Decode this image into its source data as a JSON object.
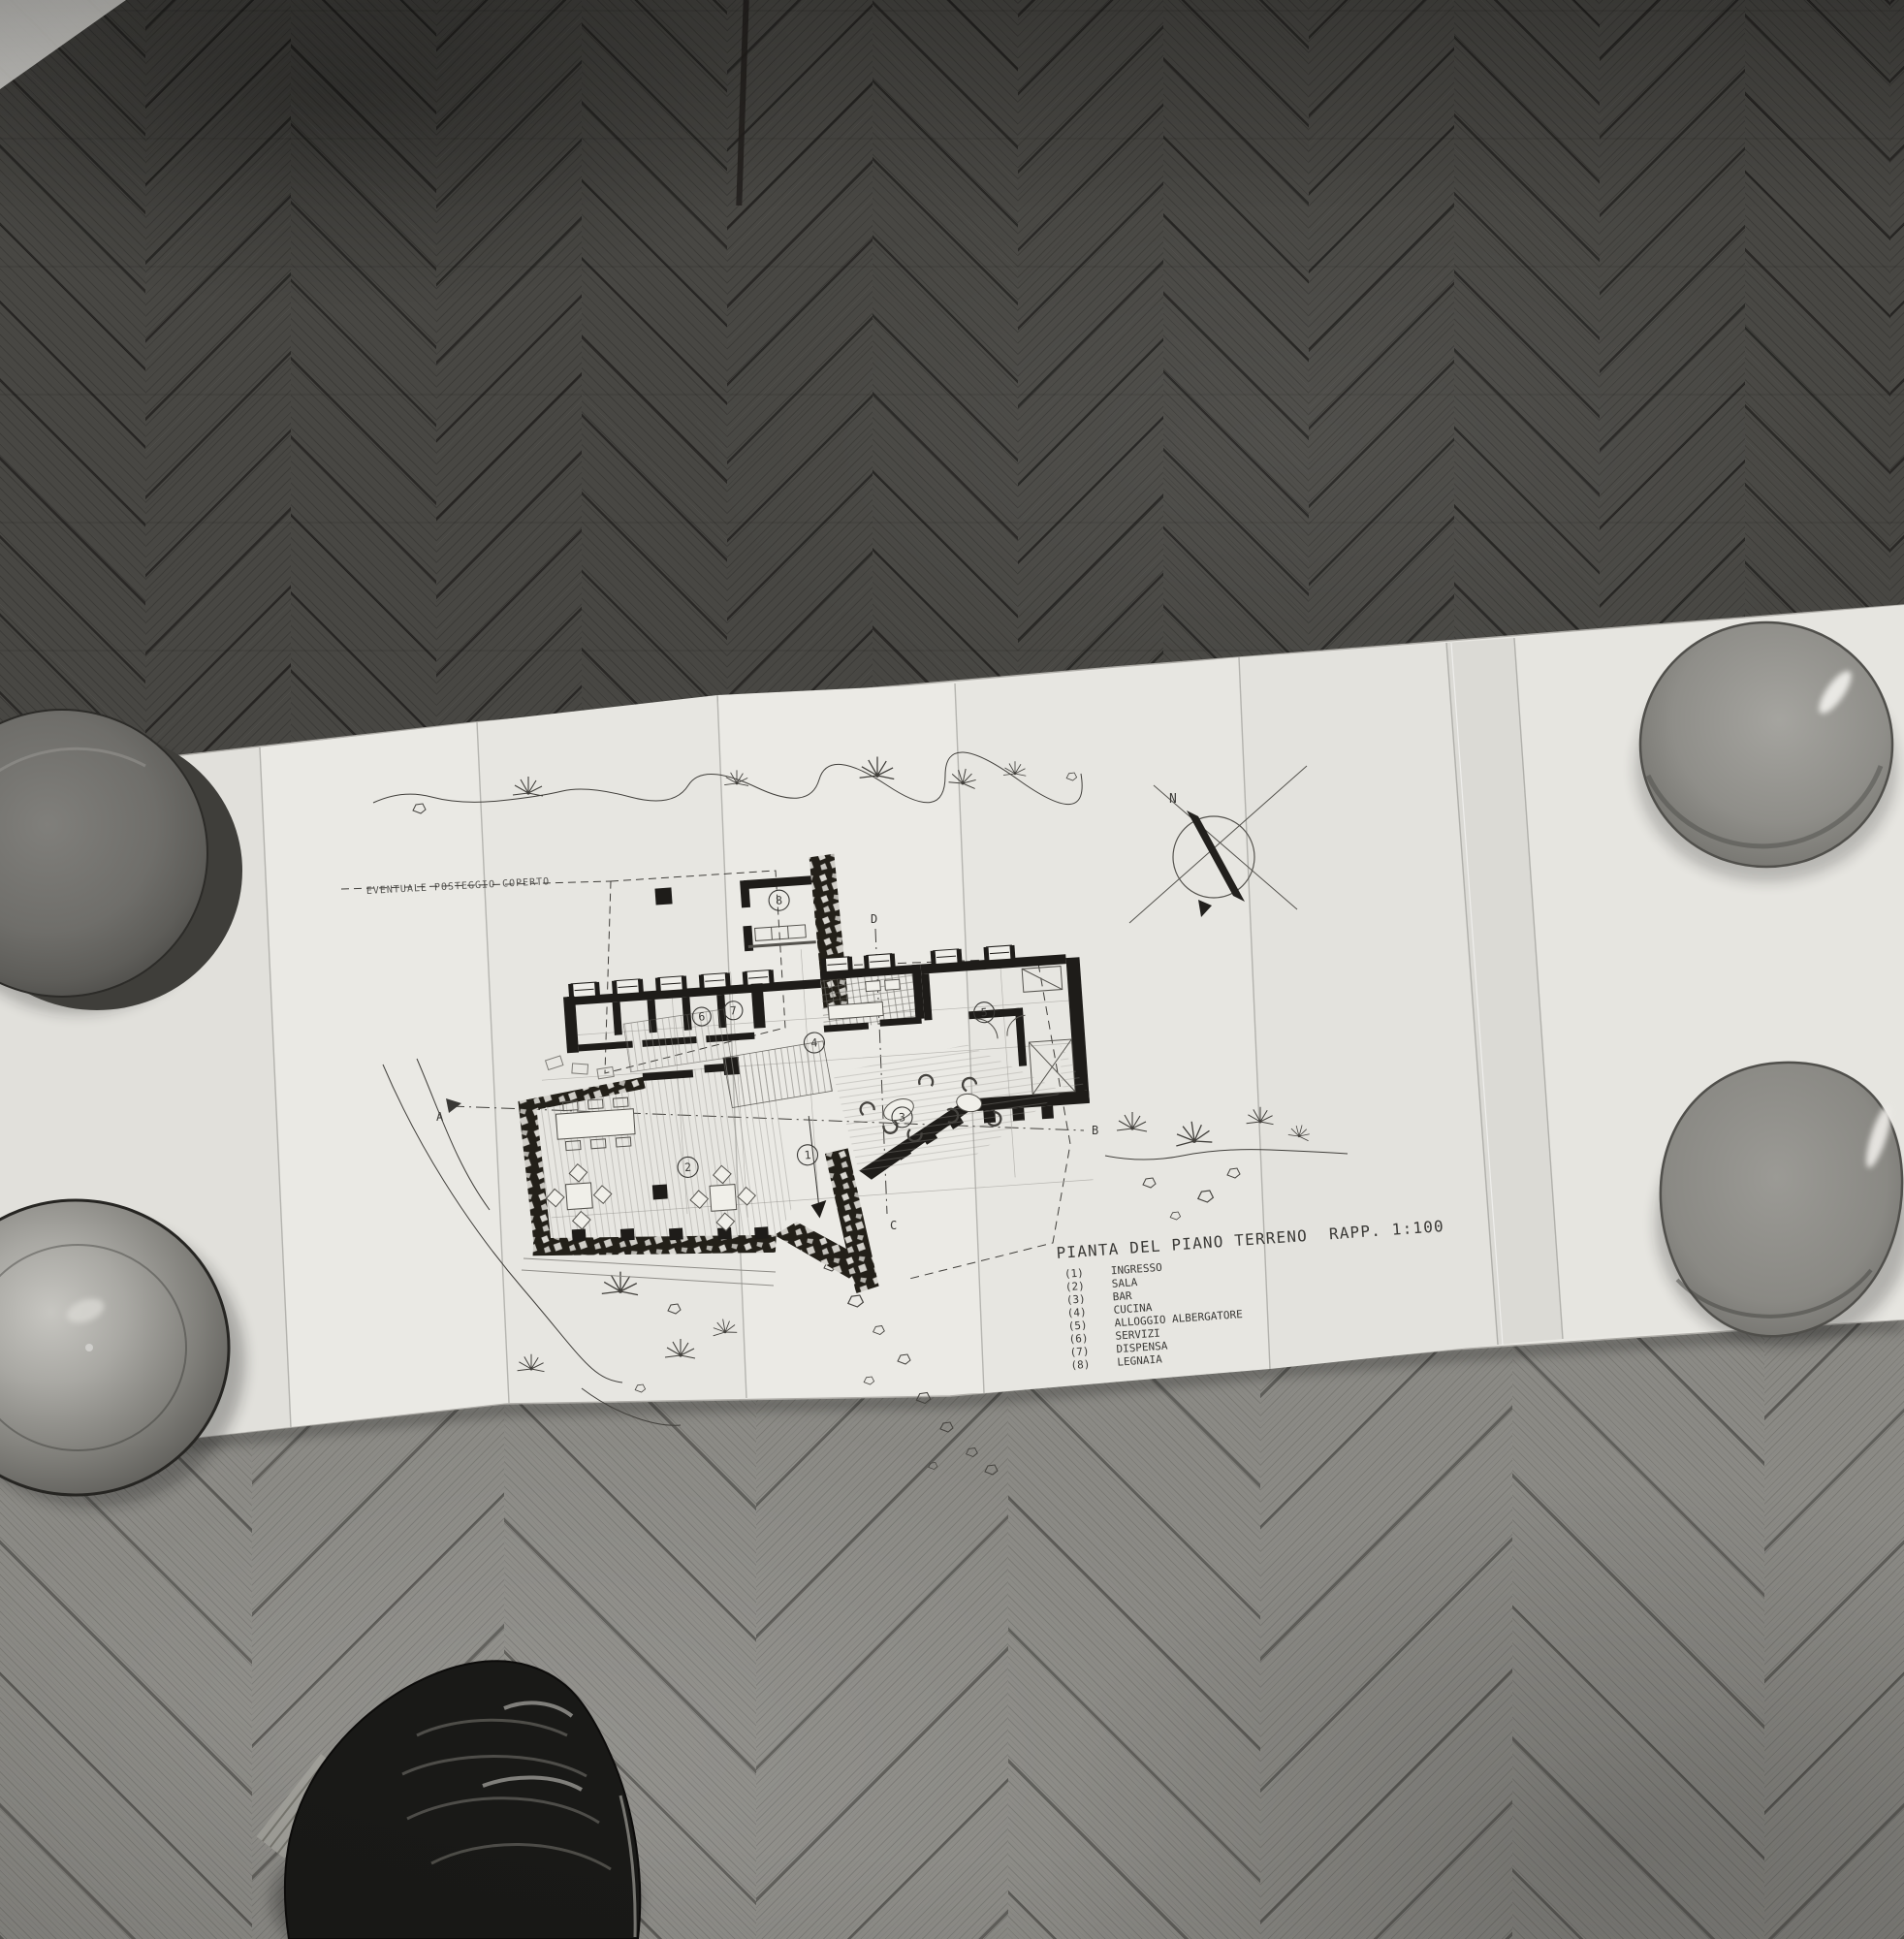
{
  "drawing": {
    "title": "PIANTA DEL PIANO TERRENO",
    "scale": "RAPP. 1:100",
    "annotation": "EVENTUALE POSTEGGIO COPERTO",
    "compass_north": "N",
    "legend": [
      {
        "num": "(1)",
        "label": "INGRESSO"
      },
      {
        "num": "(2)",
        "label": "SALA"
      },
      {
        "num": "(3)",
        "label": "BAR"
      },
      {
        "num": "(4)",
        "label": "CUCINA"
      },
      {
        "num": "(5)",
        "label": "ALLOGGIO ALBERGATORE"
      },
      {
        "num": "(6)",
        "label": "SERVIZI"
      },
      {
        "num": "(7)",
        "label": "DISPENSA"
      },
      {
        "num": "(8)",
        "label": "LEGNAIA"
      }
    ],
    "room_numbers": [
      "1",
      "2",
      "3",
      "4",
      "5",
      "6",
      "7",
      "8"
    ],
    "section_markers": {
      "a": "A",
      "b": "B",
      "c": "C",
      "d": "D"
    }
  },
  "colors": {
    "paper": "#e8e7e2",
    "ink": "#3a3936",
    "wall_black": "#1e1c19",
    "floor_dark": "#484743",
    "floor_light": "#8b8a85",
    "bowl_gray": "#8f8e89",
    "shoe_black": "#191917"
  }
}
